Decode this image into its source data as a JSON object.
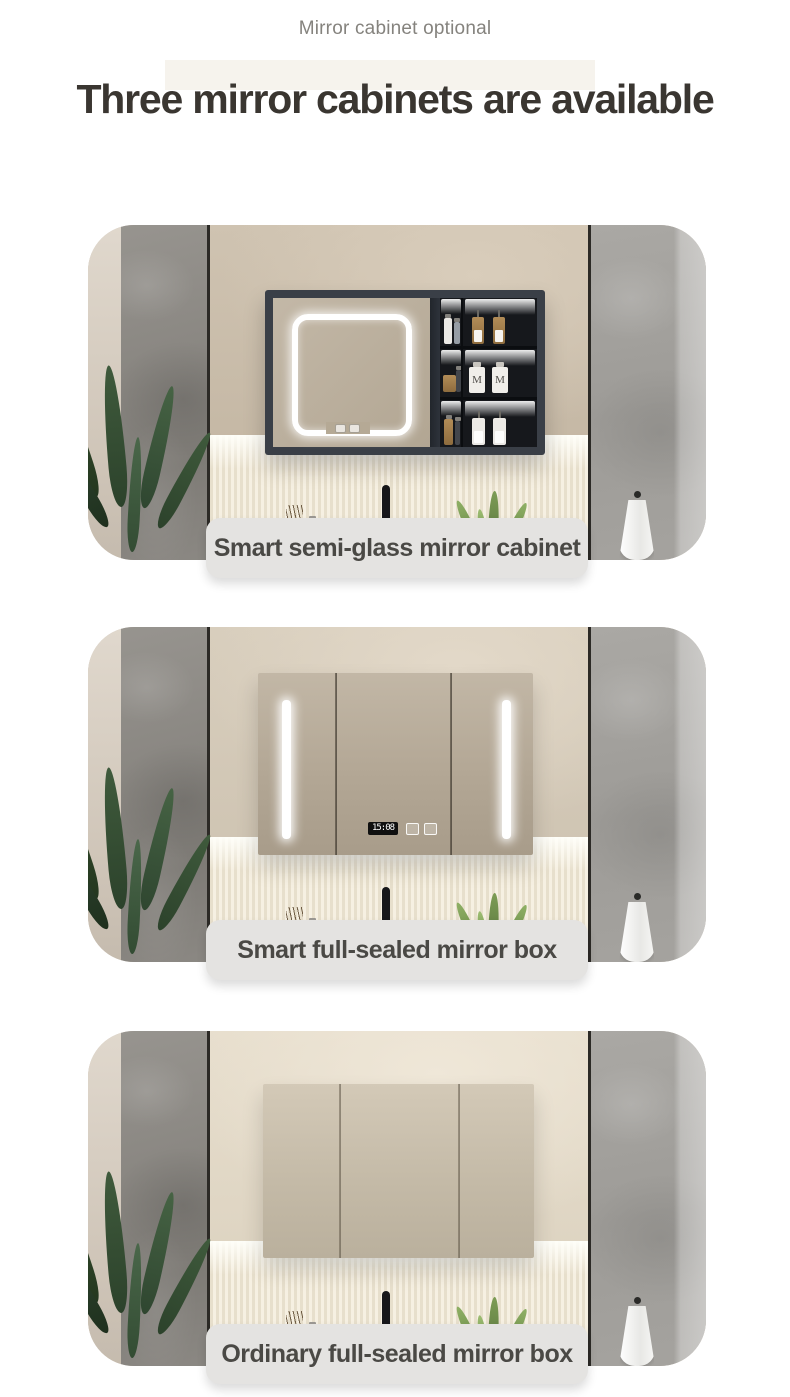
{
  "page": {
    "kicker": "Mirror cabinet optional",
    "title": "Three mirror cabinets are available"
  },
  "cards": [
    {
      "type": "smart-semi-glass",
      "label": "Smart semi-glass mirror cabinet",
      "bottle_monogram": "M"
    },
    {
      "type": "smart-full-sealed",
      "label": "Smart full-sealed mirror box",
      "clock_time": "15:08"
    },
    {
      "type": "ordinary-full-sealed",
      "label": "Ordinary full-sealed mirror box"
    }
  ],
  "colors": {
    "pill_bg": "#e4e3e1",
    "pill_text": "#4a4945",
    "title_text": "#3a3631",
    "kicker_text": "#85837e",
    "cabinet_frame": "#3a3f47",
    "led_light": "#ffffff"
  }
}
